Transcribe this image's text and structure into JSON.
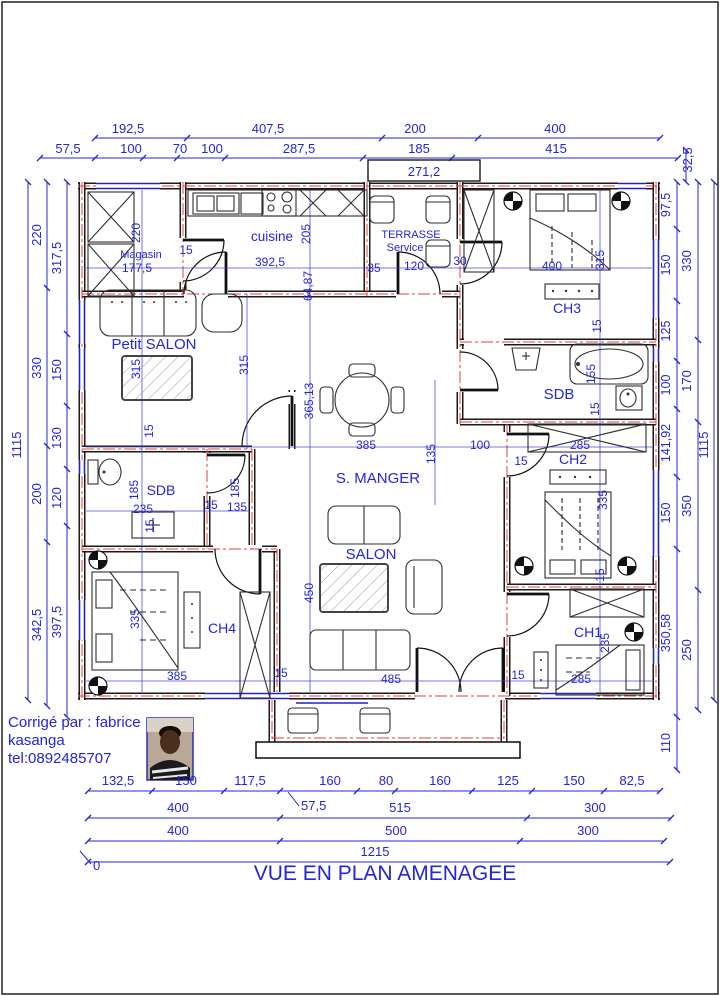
{
  "title": "VUE EN PLAN AMENAGEE",
  "credit": [
    "Corrigé par : fabrice",
    "kasanga",
    "tel:0892485707"
  ],
  "colors": {
    "dimension_blue": "#2424d8",
    "axis_red": "#e04040",
    "wall_black": "#1a1a1a"
  },
  "rooms": {
    "magasin": "Magasin",
    "cuisine": "cuisine",
    "terrasse": "TERRASSE",
    "service": "Service",
    "ch3": "CH3",
    "sdb_right": "SDB",
    "ch2": "CH2",
    "s_manger": "S. MANGER",
    "petit_salon": "Petit SALON",
    "sdb_left": "SDB",
    "ch4": "CH4",
    "salon": "SALON",
    "ch1": "CH1"
  },
  "top": {
    "row1": [
      "192,5",
      "407,5",
      "200",
      "400"
    ],
    "row2": [
      "57,5",
      "100",
      "70",
      "100",
      "287,5",
      "185",
      "415"
    ],
    "right_v": "32,5",
    "box": "271,2"
  },
  "left": {
    "outer": "1115",
    "mid": [
      "220",
      "330",
      "200",
      "342,5"
    ],
    "inner": [
      "317,5",
      "150",
      "130",
      "120",
      "397,5"
    ]
  },
  "right": {
    "inner": [
      "97,5",
      "150",
      "125",
      "100",
      "141,92",
      "150",
      "350,58",
      "110"
    ],
    "mid": [
      "330",
      "170",
      "350",
      "250"
    ],
    "outer": "1115"
  },
  "bottom": {
    "row1": [
      "132,5",
      "150",
      "117,5",
      "160",
      "80",
      "160",
      "125",
      "150",
      "82,5"
    ],
    "leader": "57,5",
    "row2": [
      "400",
      "515",
      "300"
    ],
    "row3": [
      "400",
      "500",
      "300"
    ],
    "total": "1215",
    "zero": "0"
  },
  "plan_h": [
    "177,5",
    "15",
    "392,5",
    "35",
    "120",
    "30",
    "400",
    "100",
    "285",
    "15",
    "385",
    "235",
    "15",
    "135",
    "385",
    "15",
    "485",
    "285",
    "15"
  ],
  "plan_v": [
    "220",
    "205",
    "64,87",
    "315",
    "315",
    "315",
    "15",
    "155",
    "15",
    "365,13",
    "135",
    "185",
    "15",
    "15",
    "185",
    "335",
    "15",
    "335",
    "450",
    "235"
  ]
}
